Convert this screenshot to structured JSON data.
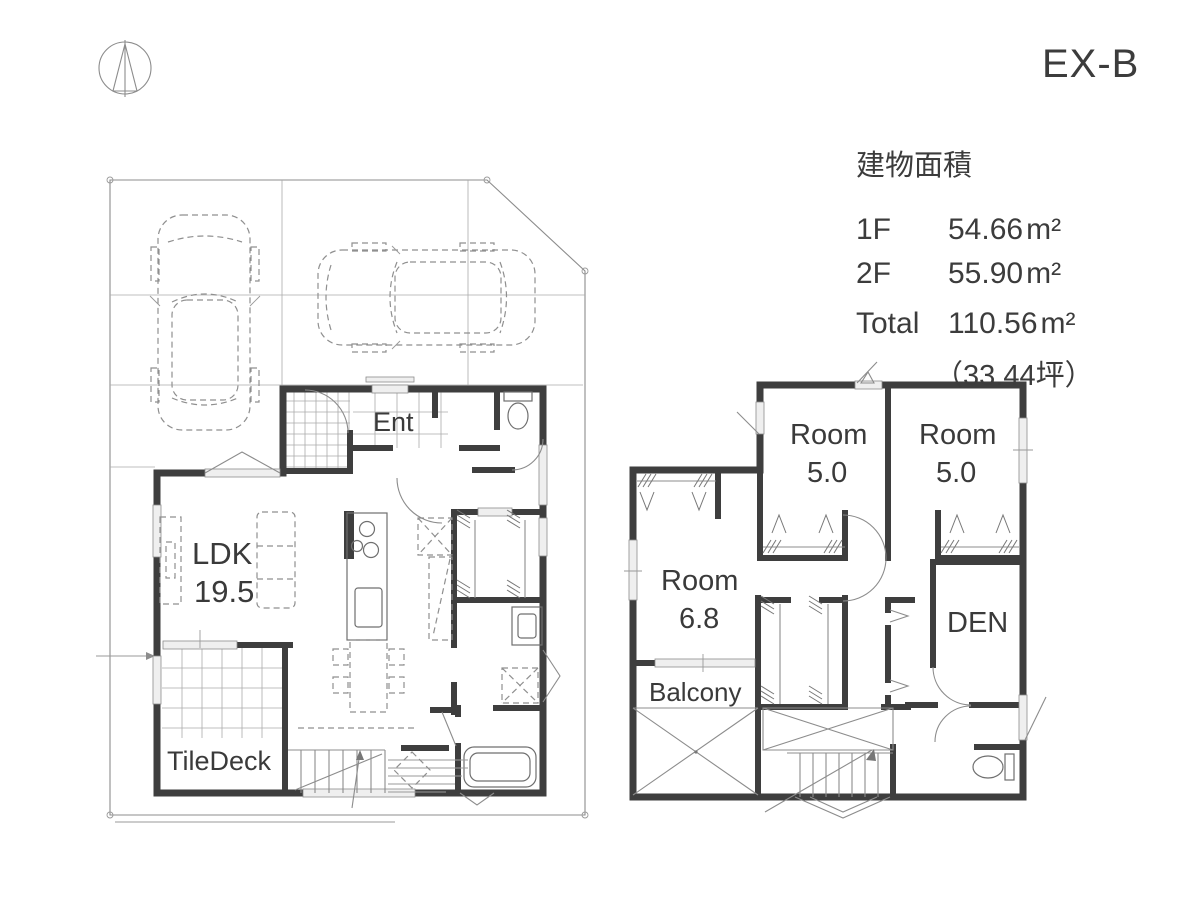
{
  "header": {
    "plan_code": "EX-B",
    "compass_icon": "north-compass-icon"
  },
  "area_table": {
    "heading": "建物面積",
    "rows": [
      {
        "label": "1F",
        "value": "54.66",
        "unit": "m²"
      },
      {
        "label": "2F",
        "value": "55.90",
        "unit": "m²"
      },
      {
        "label": "Total",
        "value": "110.56",
        "unit": "m²"
      }
    ],
    "total_tsubo": "（33.44坪）"
  },
  "floor_1f": {
    "rooms": [
      {
        "id": "entrance",
        "label": "Ent"
      },
      {
        "id": "ldk",
        "label": "LDK",
        "size": "19.5"
      },
      {
        "id": "tiledeck",
        "label": "TileDeck"
      }
    ]
  },
  "floor_2f": {
    "rooms": [
      {
        "id": "room-a",
        "label": "Room",
        "size": "5.0"
      },
      {
        "id": "room-b",
        "label": "Room",
        "size": "5.0"
      },
      {
        "id": "room-c",
        "label": "Room",
        "size": "6.8"
      },
      {
        "id": "den",
        "label": "DEN"
      },
      {
        "id": "balcony",
        "label": "Balcony"
      }
    ]
  },
  "colors": {
    "wall": "#3e3e3e",
    "line": "#8c8c8c",
    "text": "#3a3a3a",
    "window": "#efefef",
    "background": "#ffffff"
  }
}
